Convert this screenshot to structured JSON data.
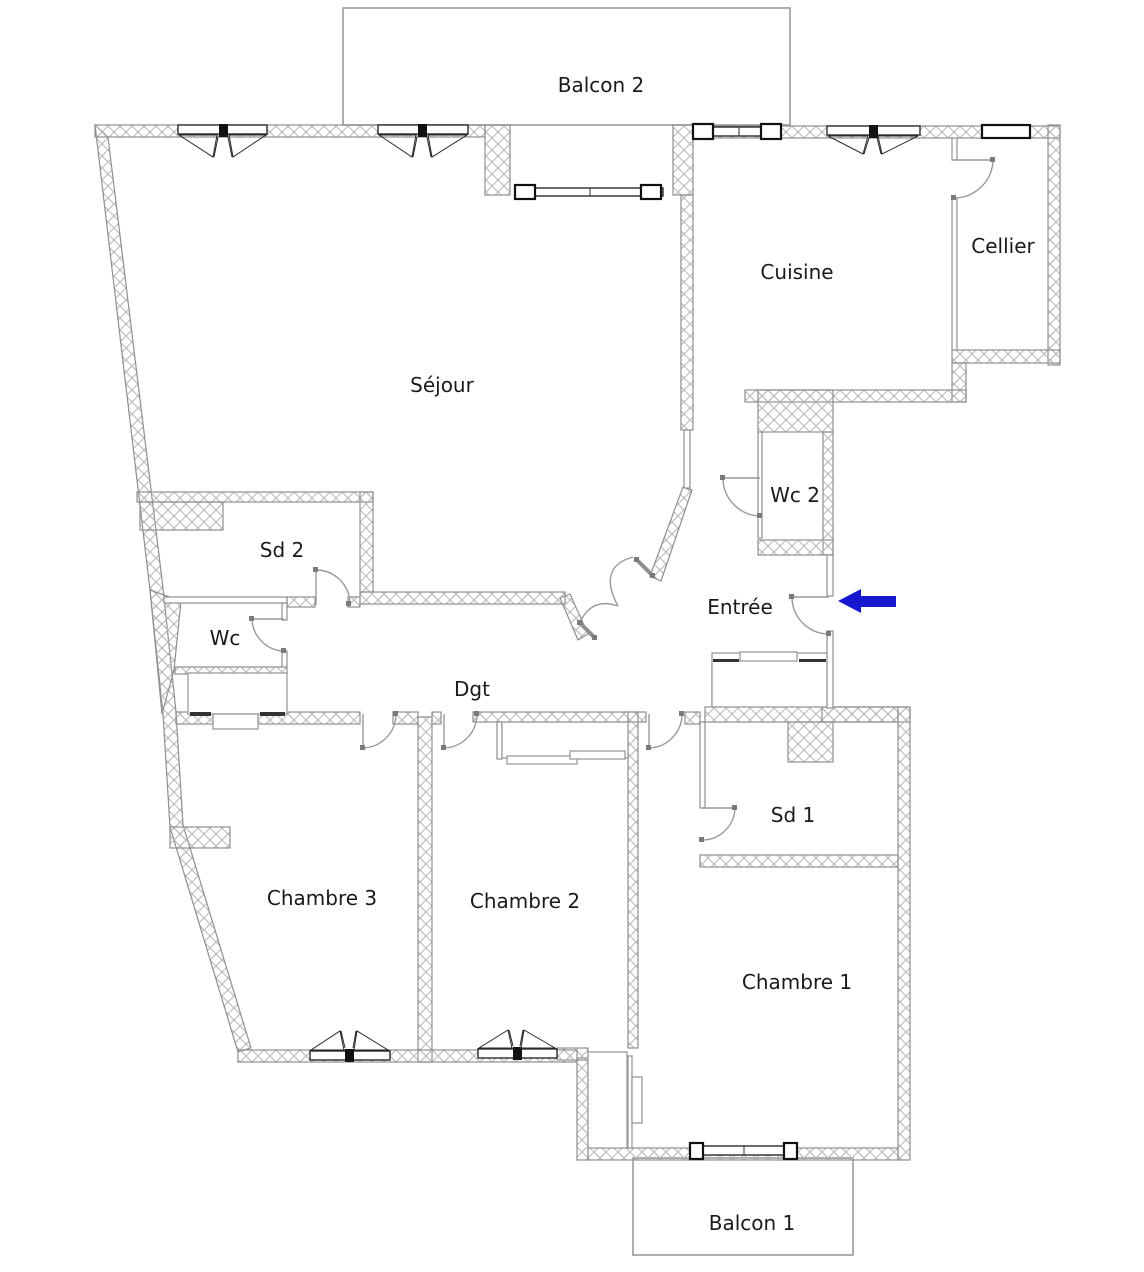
{
  "figure": "apartment-floor-plan",
  "rooms": {
    "balcon2": "Balcon 2",
    "cuisine": "Cuisine",
    "cellier": "Cellier",
    "sejour": "Séjour",
    "wc2": "Wc 2",
    "entree": "Entrée",
    "sd2": "Sd 2",
    "wc": "Wc",
    "dgt": "Dgt",
    "chambre3": "Chambre 3",
    "chambre2": "Chambre 2",
    "sd1": "Sd 1",
    "chambre1": "Chambre 1",
    "balcon1": "Balcon 1"
  },
  "icons": {
    "entrance_arrow": "left-arrow"
  },
  "colors": {
    "wall_hatch": "#b6b6b6",
    "wall_stroke": "#8f8f8f",
    "window_stroke": "#1a1a1a",
    "door_stroke": "#9a9a9a",
    "balcony_stroke": "#9a9a9a",
    "text": "#1a1a1a",
    "arrow": "#1717cf",
    "background": "#ffffff"
  }
}
